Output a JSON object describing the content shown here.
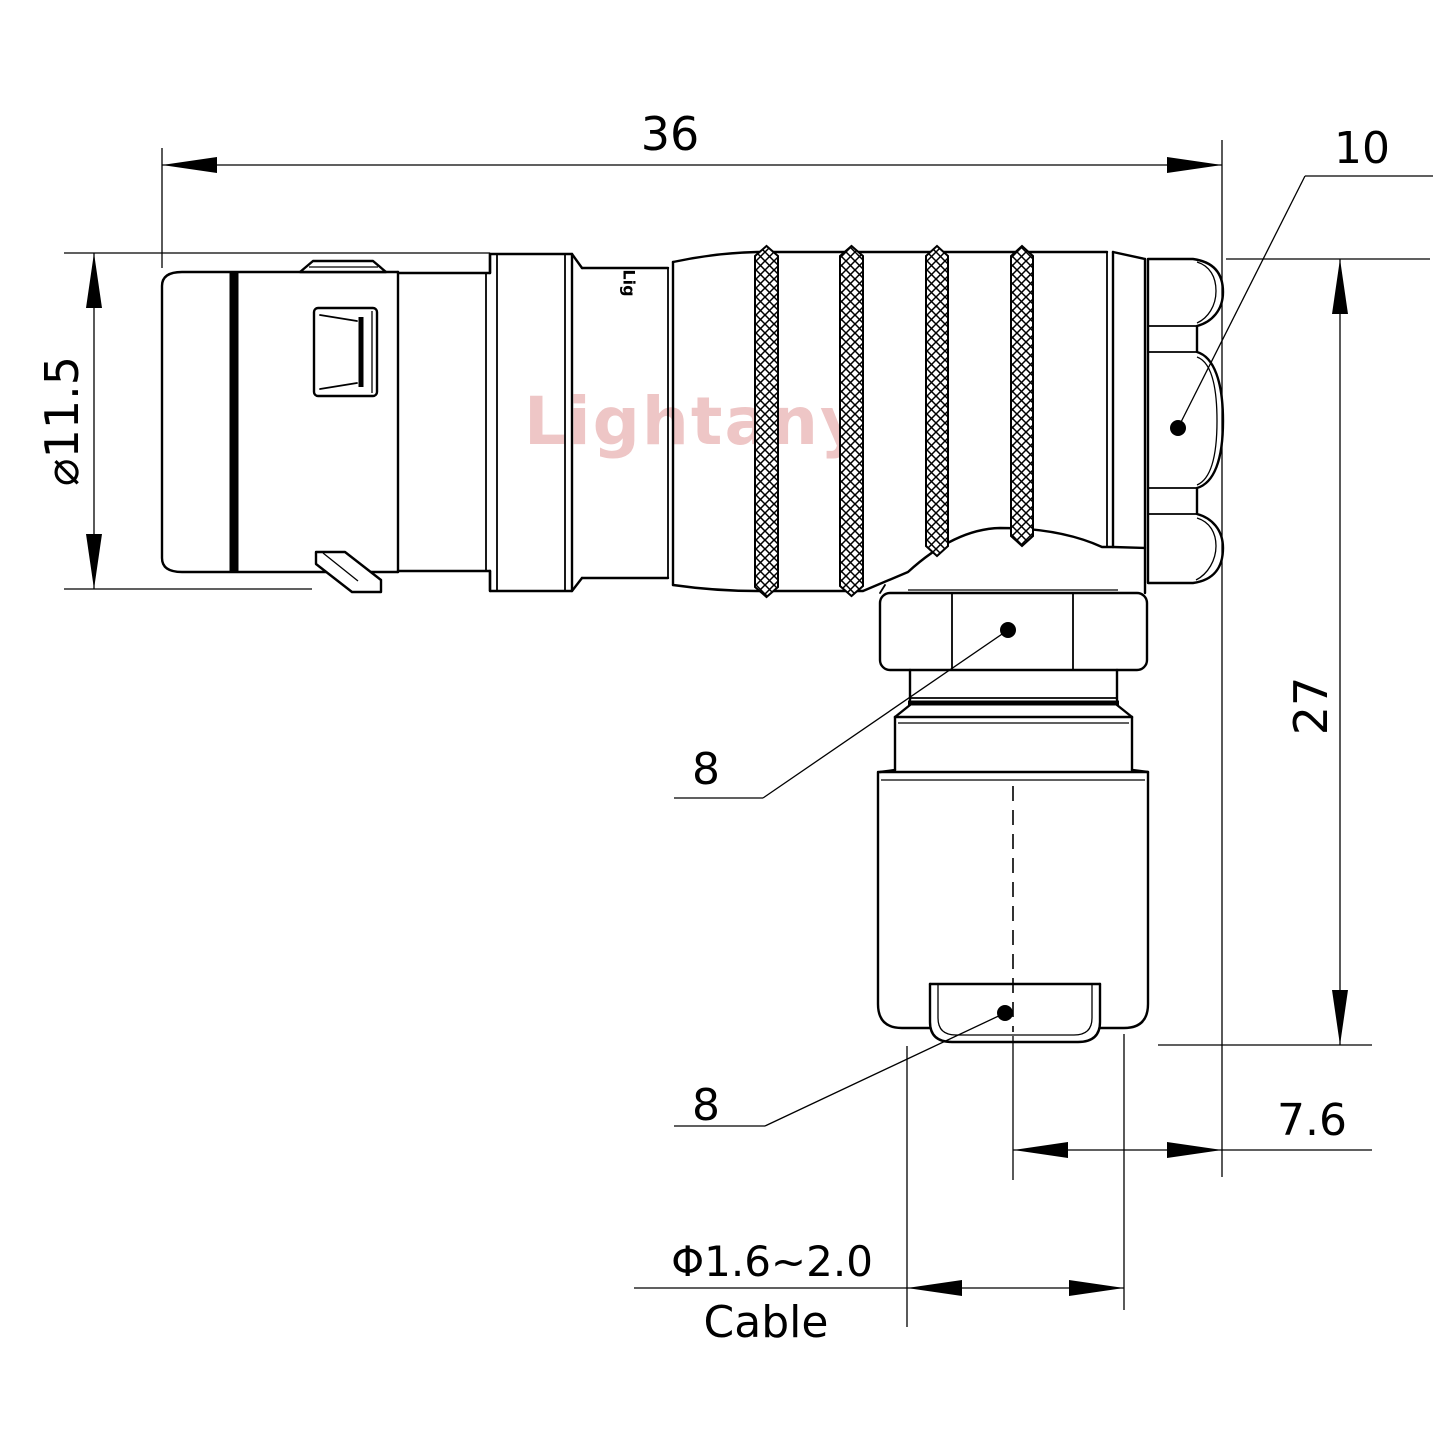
{
  "page": {
    "background": "#ffffff",
    "kind": "connector-technical-drawing"
  },
  "watermark": {
    "text": "Lightany",
    "color": "#d67676"
  },
  "drawing": {
    "body_mark": "Lig",
    "line_color": "#000000",
    "view": "right-angle plug side view with cable gland pointing down"
  },
  "dimensions": {
    "overall_length": "36",
    "cap_width": "10",
    "front_diameter": "⌀11.5",
    "overall_height": "27",
    "nut_ref": "8",
    "bushing_ref": "8",
    "exit_offset": "7.6",
    "cable_diameter": "Φ1.6~2.0",
    "cable_label": "Cable"
  }
}
